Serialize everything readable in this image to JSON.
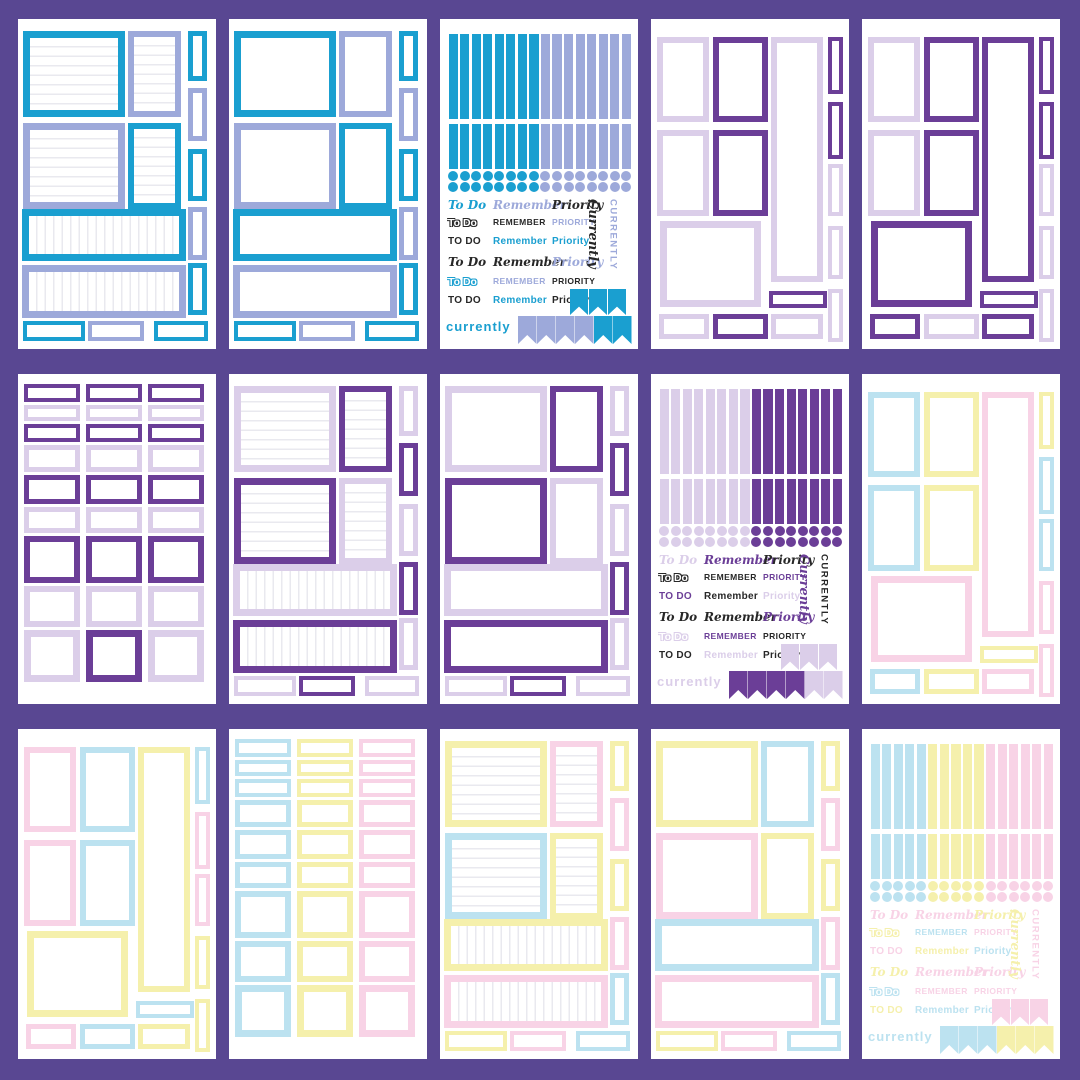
{
  "page": {
    "background": "#594792",
    "card_color": "#ffffff",
    "grid": "5x3 sticker sheets"
  },
  "palette": {
    "teal": "#1A9FD0",
    "peri": "#9DA9DA",
    "purple": "#6B3E97",
    "lilac": "#DBCEE9",
    "blue": "#BCE2F0",
    "yellow": "#F5F0AC",
    "pink": "#F8D3E6",
    "black": "#272727",
    "line": "#e9e9ef"
  },
  "sheets": [
    {
      "kind": "classic",
      "lined": true,
      "slots": {
        "A": "teal",
        "B": "peri",
        "C": "peri",
        "D": "teal",
        "W1": "teal",
        "W2": "peri"
      },
      "strips": [
        "teal",
        "peri",
        "teal",
        "peri",
        "teal"
      ],
      "bottom": [
        "teal",
        "peri",
        "teal"
      ]
    },
    {
      "kind": "classic",
      "lined": false,
      "slots": {
        "A": "teal",
        "B": "peri",
        "C": "peri",
        "D": "teal",
        "W1": "teal",
        "W2": "peri"
      },
      "strips": [
        "teal",
        "peri",
        "teal",
        "peri",
        "teal"
      ],
      "bottom": [
        "teal",
        "peri",
        "teal"
      ]
    },
    {
      "kind": "sampler",
      "strips": [
        "teal",
        "teal",
        "teal",
        "teal",
        "teal",
        "teal",
        "teal",
        "teal",
        "peri",
        "peri",
        "peri",
        "peri",
        "peri",
        "peri",
        "peri",
        "peri"
      ],
      "dots": [
        "teal",
        "teal",
        "teal",
        "teal",
        "teal",
        "teal",
        "teal",
        "teal",
        "peri",
        "peri",
        "peri",
        "peri",
        "peri",
        "peri",
        "peri",
        "peri"
      ],
      "words": {
        "rows": [
          [
            {
              "t": "To Do",
              "c": "teal",
              "s": "script"
            },
            {
              "t": "Remember",
              "c": "peri",
              "s": "script"
            },
            {
              "t": "Priority",
              "c": "black",
              "s": "script"
            }
          ],
          [
            {
              "t": "To Do",
              "c": "black",
              "s": "outline"
            },
            {
              "t": "Remember",
              "c": "black",
              "s": "caps"
            },
            {
              "t": "Priority",
              "c": "peri",
              "s": "caps"
            }
          ],
          [
            {
              "t": "TO DO",
              "c": "black",
              "s": "plain"
            },
            {
              "t": "Remember",
              "c": "teal",
              "s": "plain"
            },
            {
              "t": "Priority",
              "c": "teal",
              "s": "plain"
            }
          ],
          [
            {
              "t": "To Do",
              "c": "black",
              "s": "script"
            },
            {
              "t": "Remember",
              "c": "black",
              "s": "script"
            },
            {
              "t": "Priority",
              "c": "peri",
              "s": "script"
            }
          ],
          [
            {
              "t": "To Do",
              "c": "teal",
              "s": "outline"
            },
            {
              "t": "Remember",
              "c": "peri",
              "s": "caps"
            },
            {
              "t": "Priority",
              "c": "black",
              "s": "caps"
            }
          ],
          [
            {
              "t": "TO DO",
              "c": "black",
              "s": "plain"
            },
            {
              "t": "Remember",
              "c": "teal",
              "s": "plain"
            },
            {
              "t": "Priority",
              "c": "black",
              "s": "plain"
            }
          ]
        ],
        "vertical": [
          {
            "t": "Currently",
            "c": "black",
            "s": "script"
          },
          {
            "t": "CURRENTLY",
            "c": "peri",
            "s": "caps"
          }
        ],
        "bottom": {
          "t": "currently",
          "c": "teal"
        },
        "pen_top": [
          "teal",
          "teal",
          "teal"
        ],
        "pen_bottom": [
          "peri",
          "peri",
          "peri",
          "peri",
          "teal",
          "teal"
        ]
      }
    },
    {
      "kind": "vertical",
      "slots": {
        "v1": "lilac",
        "v2": "lilac",
        "big": "lilac",
        "b1": "lilac",
        "v3": "purple",
        "v4": "purple",
        "b2": "purple",
        "tall": "lilac",
        "smallH": "purple",
        "b3": "lilac"
      },
      "strips": [
        "purple",
        "purple",
        "lilac",
        "lilac",
        "lilac"
      ]
    },
    {
      "kind": "vertical",
      "slots": {
        "v1": "lilac",
        "v2": "lilac",
        "big": "purple",
        "b1": "purple",
        "v3": "purple",
        "v4": "purple",
        "b2": "lilac",
        "tall": "purple",
        "smallH": "purple",
        "b3": "purple"
      },
      "strips": [
        "purple",
        "purple",
        "lilac",
        "lilac",
        "lilac"
      ]
    },
    {
      "kind": "grid",
      "rows": [
        [
          "purple",
          "purple",
          "purple"
        ],
        [
          "lilac",
          "lilac",
          "lilac"
        ],
        [
          "purple",
          "purple",
          "purple"
        ],
        [
          "lilac",
          "lilac",
          "lilac"
        ],
        [
          "purple",
          "purple",
          "purple"
        ],
        [
          "lilac",
          "lilac",
          "lilac"
        ],
        [
          "purple",
          "purple",
          "purple"
        ],
        [
          "lilac",
          "lilac",
          "lilac"
        ],
        [
          "lilac",
          "purple",
          "lilac"
        ]
      ]
    },
    {
      "kind": "classic",
      "lined": true,
      "slots": {
        "A": "lilac",
        "B": "purple",
        "C": "purple",
        "D": "lilac",
        "W1": "lilac",
        "W2": "purple"
      },
      "strips": [
        "lilac",
        "purple",
        "lilac",
        "purple",
        "lilac"
      ],
      "bottom": [
        "lilac",
        "purple",
        "lilac"
      ]
    },
    {
      "kind": "classic",
      "lined": false,
      "slots": {
        "A": "lilac",
        "B": "purple",
        "C": "purple",
        "D": "lilac",
        "W1": "lilac",
        "W2": "purple"
      },
      "strips": [
        "lilac",
        "purple",
        "lilac",
        "purple",
        "lilac"
      ],
      "bottom": [
        "lilac",
        "purple",
        "lilac"
      ]
    },
    {
      "kind": "sampler",
      "strips": [
        "lilac",
        "lilac",
        "lilac",
        "lilac",
        "lilac",
        "lilac",
        "lilac",
        "lilac",
        "purple",
        "purple",
        "purple",
        "purple",
        "purple",
        "purple",
        "purple",
        "purple"
      ],
      "dots": [
        "lilac",
        "lilac",
        "lilac",
        "lilac",
        "lilac",
        "lilac",
        "lilac",
        "lilac",
        "purple",
        "purple",
        "purple",
        "purple",
        "purple",
        "purple",
        "purple",
        "purple"
      ],
      "words": {
        "rows": [
          [
            {
              "t": "To Do",
              "c": "lilac",
              "s": "script"
            },
            {
              "t": "Remember",
              "c": "purple",
              "s": "script"
            },
            {
              "t": "Priority",
              "c": "black",
              "s": "script"
            }
          ],
          [
            {
              "t": "To Do",
              "c": "black",
              "s": "outline"
            },
            {
              "t": "Remember",
              "c": "black",
              "s": "caps"
            },
            {
              "t": "Priority",
              "c": "purple",
              "s": "caps"
            }
          ],
          [
            {
              "t": "TO DO",
              "c": "purple",
              "s": "plain"
            },
            {
              "t": "Remember",
              "c": "black",
              "s": "plain"
            },
            {
              "t": "Priority",
              "c": "lilac",
              "s": "plain"
            }
          ],
          [
            {
              "t": "To Do",
              "c": "black",
              "s": "script"
            },
            {
              "t": "Remember",
              "c": "black",
              "s": "script"
            },
            {
              "t": "Priority",
              "c": "purple",
              "s": "script"
            }
          ],
          [
            {
              "t": "To Do",
              "c": "lilac",
              "s": "outline"
            },
            {
              "t": "Remember",
              "c": "purple",
              "s": "caps"
            },
            {
              "t": "Priority",
              "c": "black",
              "s": "caps"
            }
          ],
          [
            {
              "t": "TO DO",
              "c": "black",
              "s": "plain"
            },
            {
              "t": "Remember",
              "c": "lilac",
              "s": "plain"
            },
            {
              "t": "Priority",
              "c": "black",
              "s": "plain"
            }
          ]
        ],
        "vertical": [
          {
            "t": "Currently",
            "c": "purple",
            "s": "script"
          },
          {
            "t": "CURRENTLY",
            "c": "black",
            "s": "caps"
          }
        ],
        "bottom": {
          "t": "currently",
          "c": "lilac"
        },
        "pen_top": [
          "lilac",
          "lilac",
          "lilac"
        ],
        "pen_bottom": [
          "purple",
          "purple",
          "purple",
          "purple",
          "lilac",
          "lilac"
        ]
      }
    },
    {
      "kind": "vertical",
      "slots": {
        "v1": "blue",
        "v2": "blue",
        "big": "pink",
        "b1": "blue",
        "v3": "yellow",
        "v4": "yellow",
        "b2": "yellow",
        "tall": "pink",
        "smallH": "yellow",
        "b3": "pink"
      },
      "strips": [
        "yellow",
        "blue",
        "blue",
        "pink",
        "pink"
      ]
    },
    {
      "kind": "vertical",
      "slots": {
        "v1": "pink",
        "v2": "pink",
        "big": "yellow",
        "b1": "pink",
        "v3": "blue",
        "v4": "blue",
        "b2": "blue",
        "tall": "yellow",
        "smallH": "blue",
        "b3": "yellow"
      },
      "strips": [
        "blue",
        "pink",
        "pink",
        "yellow",
        "yellow"
      ]
    },
    {
      "kind": "grid",
      "rows": [
        [
          "blue",
          "yellow",
          "pink"
        ],
        [
          "blue",
          "yellow",
          "pink"
        ],
        [
          "blue",
          "yellow",
          "pink"
        ],
        [
          "blue",
          "yellow",
          "pink"
        ],
        [
          "blue",
          "yellow",
          "pink"
        ],
        [
          "blue",
          "yellow",
          "pink"
        ],
        [
          "blue",
          "yellow",
          "pink"
        ],
        [
          "blue",
          "yellow",
          "pink"
        ],
        [
          "blue",
          "yellow",
          "pink"
        ]
      ]
    },
    {
      "kind": "classic",
      "lined": true,
      "slots": {
        "A": "yellow",
        "B": "pink",
        "C": "blue",
        "D": "yellow",
        "W1": "yellow",
        "W2": "pink"
      },
      "strips": [
        "yellow",
        "pink",
        "yellow",
        "pink",
        "blue"
      ],
      "bottom": [
        "yellow",
        "pink",
        "blue"
      ]
    },
    {
      "kind": "classic",
      "lined": false,
      "slots": {
        "A": "yellow",
        "B": "blue",
        "C": "pink",
        "D": "yellow",
        "W1": "blue",
        "W2": "pink"
      },
      "strips": [
        "yellow",
        "pink",
        "yellow",
        "pink",
        "blue"
      ],
      "bottom": [
        "yellow",
        "pink",
        "blue"
      ]
    },
    {
      "kind": "sampler",
      "strips": [
        "blue",
        "blue",
        "blue",
        "blue",
        "blue",
        "yellow",
        "yellow",
        "yellow",
        "yellow",
        "yellow",
        "pink",
        "pink",
        "pink",
        "pink",
        "pink",
        "pink"
      ],
      "dots": [
        "blue",
        "blue",
        "blue",
        "blue",
        "blue",
        "yellow",
        "yellow",
        "yellow",
        "yellow",
        "yellow",
        "pink",
        "pink",
        "pink",
        "pink",
        "pink",
        "pink"
      ],
      "words": {
        "rows": [
          [
            {
              "t": "To Do",
              "c": "pink",
              "s": "script"
            },
            {
              "t": "Remember",
              "c": "pink",
              "s": "script"
            },
            {
              "t": "Priority",
              "c": "yellow",
              "s": "script"
            }
          ],
          [
            {
              "t": "To Do",
              "c": "yellow",
              "s": "outline"
            },
            {
              "t": "Remember",
              "c": "blue",
              "s": "caps"
            },
            {
              "t": "Priority",
              "c": "pink",
              "s": "caps"
            }
          ],
          [
            {
              "t": "TO DO",
              "c": "pink",
              "s": "plain"
            },
            {
              "t": "Remember",
              "c": "yellow",
              "s": "plain"
            },
            {
              "t": "Priority",
              "c": "blue",
              "s": "plain"
            }
          ],
          [
            {
              "t": "To Do",
              "c": "yellow",
              "s": "script"
            },
            {
              "t": "Remember",
              "c": "pink",
              "s": "script"
            },
            {
              "t": "Priority",
              "c": "pink",
              "s": "script"
            }
          ],
          [
            {
              "t": "To Do",
              "c": "blue",
              "s": "outline"
            },
            {
              "t": "Remember",
              "c": "pink",
              "s": "caps"
            },
            {
              "t": "Priority",
              "c": "pink",
              "s": "caps"
            }
          ],
          [
            {
              "t": "TO DO",
              "c": "yellow",
              "s": "plain"
            },
            {
              "t": "Remember",
              "c": "blue",
              "s": "plain"
            },
            {
              "t": "Priority",
              "c": "blue",
              "s": "plain"
            }
          ]
        ],
        "vertical": [
          {
            "t": "Currently",
            "c": "yellow",
            "s": "script"
          },
          {
            "t": "CURRENTLY",
            "c": "pink",
            "s": "caps"
          }
        ],
        "bottom": {
          "t": "currently",
          "c": "blue"
        },
        "pen_top": [
          "pink",
          "pink",
          "pink"
        ],
        "pen_bottom": [
          "blue",
          "blue",
          "blue",
          "yellow",
          "yellow",
          "yellow"
        ]
      }
    }
  ]
}
